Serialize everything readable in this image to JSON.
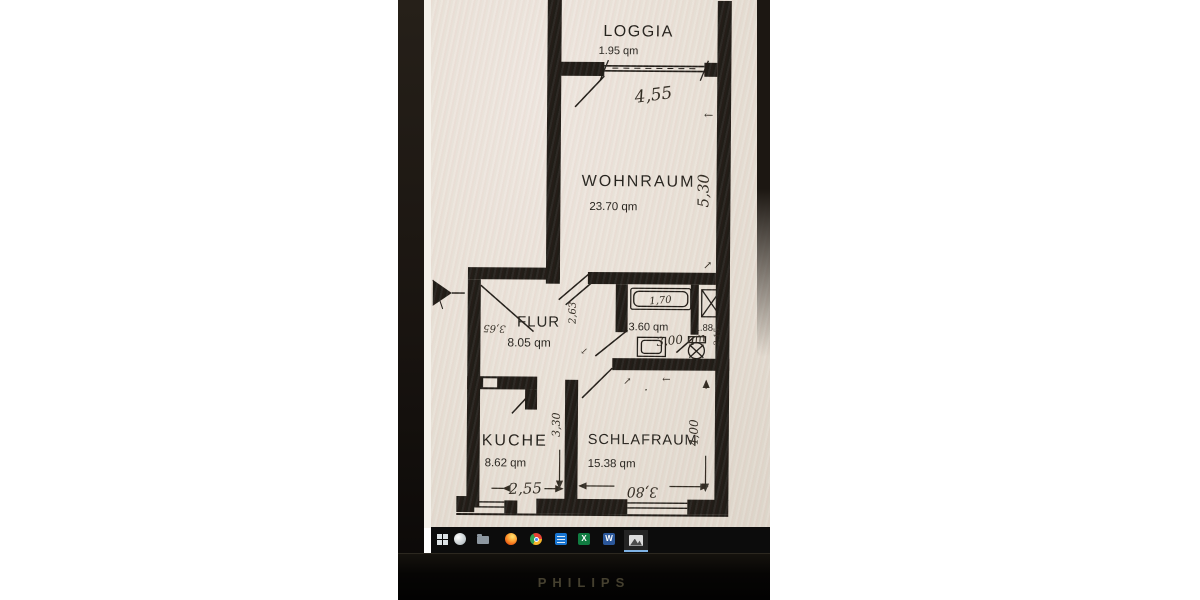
{
  "monitor": {
    "brand": "PHILIPS"
  },
  "taskbar": {
    "icons": [
      {
        "name": "start-icon",
        "glyph": ""
      },
      {
        "name": "search-icon",
        "glyph": ""
      },
      {
        "name": "file-explorer-icon",
        "glyph": ""
      },
      {
        "name": "firefox-icon",
        "glyph": ""
      },
      {
        "name": "chrome-icon",
        "glyph": ""
      },
      {
        "name": "calendar-app-icon",
        "glyph": ""
      },
      {
        "name": "excel-icon",
        "glyph": "X"
      },
      {
        "name": "word-icon",
        "glyph": "W"
      },
      {
        "name": "photos-icon",
        "glyph": ""
      }
    ]
  },
  "floorplan": {
    "loggia": {
      "label": "LOGGIA",
      "area": "1.95 qm",
      "width_dim": "4,55"
    },
    "wohnraum": {
      "label": "WOHNRAUM",
      "area": "23.70 qm",
      "height_dim": "5,30"
    },
    "flur": {
      "label": "FLUR",
      "area": "8.05 qm",
      "left_dim": "3,65",
      "right_dim": "2,63"
    },
    "bad": {
      "area": "3.60 qm",
      "handwritten_area": "3,00 qm",
      "tub_dim": "1,70"
    },
    "wc": {
      "area": "1.88",
      "depth_dim": "2,15"
    },
    "kueche": {
      "label": "KUCHE",
      "area": "8.62 qm",
      "width_dim": "2,55",
      "height_dim": "3,30"
    },
    "schlafraum": {
      "label": "SCHLAFRAUM",
      "area": "15.38 qm",
      "width_dim": "3,80",
      "height_dim": "4,00"
    },
    "marks": {
      "dim_arrow_up": "←",
      "dim_arrow_dn": "↗",
      "flur_arrow": "↙",
      "door_arrow_1": "↗",
      "door_arrow_2": "←",
      "dot": "."
    }
  }
}
